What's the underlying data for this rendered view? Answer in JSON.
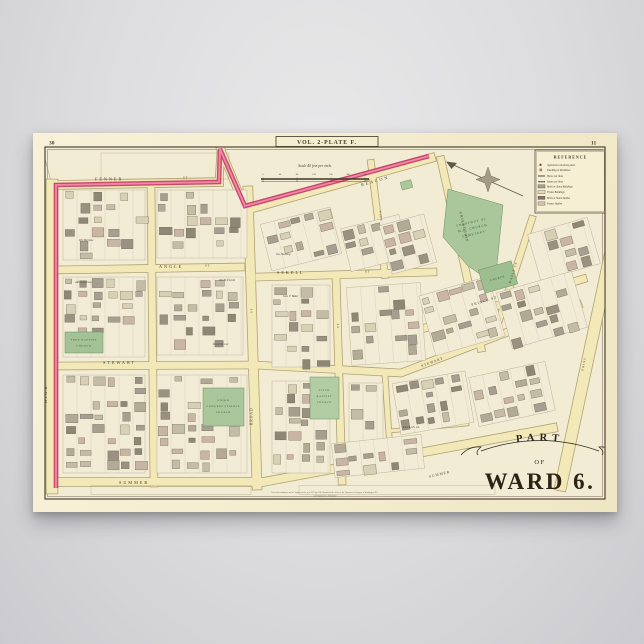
{
  "colors": {
    "mockup_background": "#dcdcde",
    "paper": "#f4ecce",
    "street_yellow": "#f2e8b8",
    "street_edge": "#b0a274",
    "boundary_pink": "#c73a63",
    "boundary_pink_light": "#ef89a8",
    "park_green": "#a9c79b",
    "building_gray": "#a69f8f",
    "frame_ink": "#3e3627"
  },
  "plate": {
    "page_left": "30",
    "page_right": "11",
    "title": "VOL. 2-PLATE F.",
    "scale_heading": "Scale 40 feet per inch.",
    "scale_ticks": [
      "0",
      "40",
      "80",
      "120",
      "160",
      "200",
      "240"
    ],
    "imprint_line1": "Entered according to act of Congress in the year 1875 by G.M. Hopkins in the office of the Librarian of Congress at Washington D.C.",
    "imprint_line2": "G.M. Hopkins & Co. Philadelphia"
  },
  "ward": {
    "part": "PART",
    "of": "OF",
    "name": "WARD 6."
  },
  "reference": {
    "title": "REFERENCE",
    "items": [
      "represents a business place",
      "Dwelling or Residence",
      "Horse car lines",
      "Steam car lines",
      "Brick or Stone Buildings",
      "Frame Buildings",
      "Brick or Stone Stables",
      "Frame Stables"
    ]
  },
  "streets": {
    "fenner": "FENNER",
    "high": "HIGH",
    "angle": "ANGLE",
    "broad": "BROAD",
    "sekell": "SEKELL",
    "stewart": "STEWART",
    "stewart2": "STEWART",
    "summer": "SUMMER",
    "summer2": "SUMMER",
    "beacon": "BEACON",
    "friendship": "FRIENDSHIP",
    "pine": "PINE",
    "maple": "MAPLE ST",
    "prince": "PRINCE ST",
    "point": "POINT",
    "pallas": "PALLAS AL",
    "st": "ST"
  },
  "landmarks": {
    "cemetery1": "CHESTNUT ST",
    "cemetery2": "M.E. CHURCH",
    "cemetery3": "CEMETERY",
    "union1": "UNION",
    "union2": "CONGREGATIONAL",
    "union3": "CHURCH",
    "fifth1": "FIFTH",
    "fifth2": "BAPTIST",
    "fifth3": "CHURCH",
    "free1": "FREE BAPTIST",
    "free2": "CHURCH",
    "church_small": "CHURCH"
  },
  "owners": {
    "o1": "Alfred Anthony",
    "o2": "Wm Barstow",
    "o3": "Wm B. Everett",
    "o4": "Daniel R. Lee",
    "o5": "Jas. Bowling",
    "o6": "Geo. F. Baker"
  }
}
